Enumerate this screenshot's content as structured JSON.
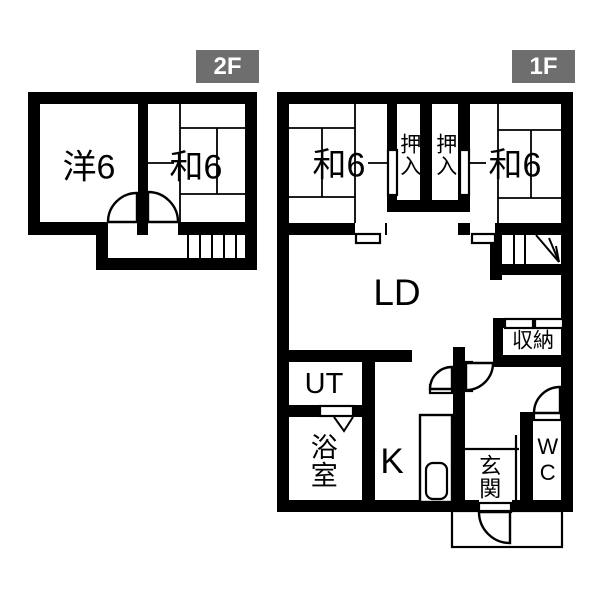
{
  "title": "2-story floor plan",
  "colors": {
    "wall": "#000000",
    "background": "#ffffff",
    "badge_background": "#6e6e6e",
    "badge_text": "#ffffff"
  },
  "floor2": {
    "badge": "2F",
    "rooms": {
      "western": "洋6",
      "japanese": "和6"
    }
  },
  "floor1": {
    "badge": "1F",
    "rooms": {
      "japanese_left": "和6",
      "closet_left": "押入",
      "closet_right": "押入",
      "japanese_right": "和6",
      "living_dining": "LD",
      "storage": "収納",
      "utility": "UT",
      "bath": "浴室",
      "kitchen": "K",
      "entrance": "玄関",
      "toilet": "WC"
    }
  }
}
